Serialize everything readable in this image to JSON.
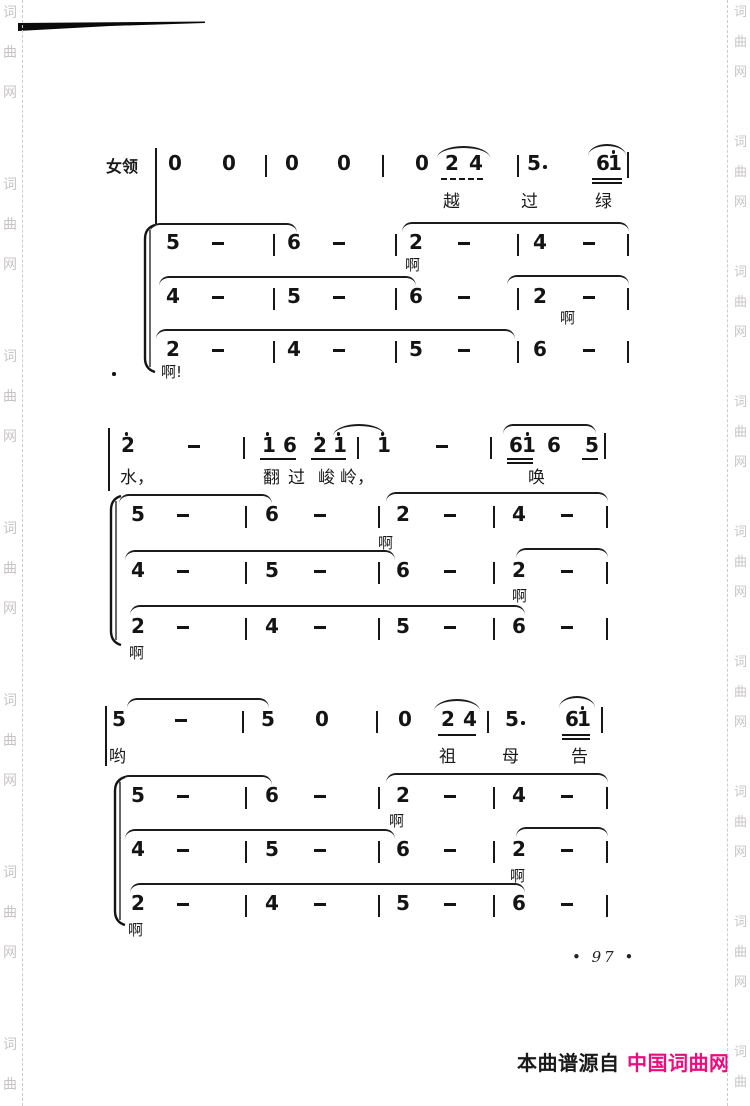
{
  "page": {
    "width": 750,
    "height": 1106,
    "background": "#ffffff"
  },
  "watermark": {
    "text": "词曲网",
    "chars": [
      "词",
      "曲",
      "网"
    ],
    "color": "#c8c4c6",
    "left": {
      "x": 3,
      "line_x": 22,
      "start": 6,
      "char_gap": 40,
      "group_period": 172,
      "font_size": 14
    },
    "right": {
      "x": 734,
      "line_x": 727,
      "start": 6,
      "char_gap": 30,
      "group_period": 130,
      "font_size": 13
    }
  },
  "artifact": {
    "points": "18,3 205,1.5 205,3 110,6 18,11",
    "color": "#0a0a0a"
  },
  "page_number": {
    "text": "• 97 •",
    "x": 572,
    "y": 948
  },
  "footer": {
    "left": {
      "text": "本曲谱源自",
      "x": 517,
      "y": 1053,
      "color": "#1a1a1a"
    },
    "right": {
      "text": "中国词曲网",
      "x": 627,
      "y": 1053,
      "color": "#ef0b7e"
    }
  },
  "score": {
    "ink": "#141414",
    "label": {
      "text": "女领",
      "x": 106,
      "y": 159,
      "fs": 16
    },
    "stray_dot": {
      "x": 112,
      "y": 372
    },
    "braces": [
      {
        "x": 142,
        "y1": 224,
        "y2": 373
      },
      {
        "x": 108,
        "y1": 495,
        "y2": 646
      },
      {
        "x": 112,
        "y1": 776,
        "y2": 926
      }
    ],
    "rows": [
      {
        "name": "system1-lead",
        "y": 157,
        "tokens": [
          {
            "x": 155,
            "c": "|",
            "dy": -9,
            "h": 76
          },
          {
            "x": 168,
            "c": "0"
          },
          {
            "x": 222,
            "c": "0"
          },
          {
            "x": 265,
            "c": "|"
          },
          {
            "x": 285,
            "c": "0"
          },
          {
            "x": 337,
            "c": "0"
          },
          {
            "x": 382,
            "c": "|"
          },
          {
            "x": 415,
            "c": "0"
          },
          {
            "x": 445,
            "c": "2"
          },
          {
            "x": 469,
            "c": "4"
          },
          {
            "x": 517,
            "c": "|"
          },
          {
            "x": 527,
            "c": "5",
            "aug": true
          },
          {
            "x": 596,
            "c": "6"
          },
          {
            "x": 608,
            "c": "1",
            "dot": true
          },
          {
            "x": 627,
            "c": "|",
            "dy": -5,
            "h": 26
          }
        ],
        "unders": [
          {
            "x1": 441,
            "x2": 483,
            "y": 178,
            "dashed": true
          },
          {
            "x1": 592,
            "x2": 622,
            "y": 178,
            "double": true
          }
        ],
        "slurs": [
          {
            "x1": 437,
            "x2": 490,
            "y": 146,
            "arc": true
          },
          {
            "x1": 588,
            "x2": 626,
            "y": 144,
            "arc": true
          }
        ],
        "lyrics": [
          {
            "x": 443,
            "y": 194,
            "t": "越",
            "fs": 17
          },
          {
            "x": 521,
            "y": 194,
            "t": "过",
            "fs": 17
          },
          {
            "x": 595,
            "y": 194,
            "t": "绿",
            "fs": 17
          }
        ]
      },
      {
        "name": "system1-voice1",
        "y": 236,
        "tokens": [
          {
            "x": 166,
            "c": "5"
          },
          {
            "x": 212,
            "c": "-"
          },
          {
            "x": 273,
            "c": "|"
          },
          {
            "x": 287,
            "c": "6"
          },
          {
            "x": 333,
            "c": "-"
          },
          {
            "x": 395,
            "c": "|"
          },
          {
            "x": 409,
            "c": "2"
          },
          {
            "x": 458,
            "c": "-"
          },
          {
            "x": 517,
            "c": "|"
          },
          {
            "x": 533,
            "c": "4"
          },
          {
            "x": 583,
            "c": "-"
          },
          {
            "x": 627,
            "c": "|"
          }
        ],
        "slurs": [
          {
            "x1": 150,
            "x2": 297,
            "y": 223
          },
          {
            "x1": 402,
            "x2": 629,
            "y": 222
          }
        ],
        "lyrics": [
          {
            "x": 405,
            "y": 258,
            "t": "啊",
            "fs": 15
          }
        ]
      },
      {
        "name": "system1-voice2",
        "y": 290,
        "tokens": [
          {
            "x": 166,
            "c": "4"
          },
          {
            "x": 212,
            "c": "-"
          },
          {
            "x": 273,
            "c": "|"
          },
          {
            "x": 287,
            "c": "5"
          },
          {
            "x": 333,
            "c": "-"
          },
          {
            "x": 395,
            "c": "|"
          },
          {
            "x": 409,
            "c": "6"
          },
          {
            "x": 458,
            "c": "-"
          },
          {
            "x": 517,
            "c": "|"
          },
          {
            "x": 533,
            "c": "2"
          },
          {
            "x": 583,
            "c": "-"
          },
          {
            "x": 627,
            "c": "|"
          }
        ],
        "slurs": [
          {
            "x1": 159,
            "x2": 416,
            "y": 276
          },
          {
            "x1": 507,
            "x2": 629,
            "y": 275
          }
        ],
        "lyrics": [
          {
            "x": 560,
            "y": 311,
            "t": "啊",
            "fs": 15
          }
        ]
      },
      {
        "name": "system1-voice3",
        "y": 343,
        "tokens": [
          {
            "x": 166,
            "c": "2"
          },
          {
            "x": 212,
            "c": "-"
          },
          {
            "x": 273,
            "c": "|"
          },
          {
            "x": 287,
            "c": "4"
          },
          {
            "x": 333,
            "c": "-"
          },
          {
            "x": 395,
            "c": "|"
          },
          {
            "x": 409,
            "c": "5"
          },
          {
            "x": 458,
            "c": "-"
          },
          {
            "x": 517,
            "c": "|"
          },
          {
            "x": 533,
            "c": "6"
          },
          {
            "x": 583,
            "c": "-"
          },
          {
            "x": 627,
            "c": "|"
          }
        ],
        "slurs": [
          {
            "x1": 156,
            "x2": 515,
            "y": 329
          }
        ],
        "lyrics": [
          {
            "x": 161,
            "y": 365,
            "t": "啊!",
            "fs": 15
          }
        ]
      },
      {
        "name": "system2-lead",
        "y": 439,
        "tokens": [
          {
            "x": 108,
            "c": "|",
            "dy": -11,
            "h": 63
          },
          {
            "x": 121,
            "c": "2",
            "dot": true
          },
          {
            "x": 188,
            "c": "-"
          },
          {
            "x": 243,
            "c": "|"
          },
          {
            "x": 262,
            "c": "1",
            "dot": true
          },
          {
            "x": 283,
            "c": "6"
          },
          {
            "x": 313,
            "c": "2",
            "dot": true
          },
          {
            "x": 333,
            "c": "1",
            "dot": true
          },
          {
            "x": 357,
            "c": "|"
          },
          {
            "x": 377,
            "c": "1",
            "dot": true
          },
          {
            "x": 436,
            "c": "-"
          },
          {
            "x": 490,
            "c": "|"
          },
          {
            "x": 509,
            "c": "6"
          },
          {
            "x": 522,
            "c": "1",
            "dot": true
          },
          {
            "x": 547,
            "c": "6"
          },
          {
            "x": 585,
            "c": "5"
          },
          {
            "x": 604,
            "c": "|",
            "dy": -6,
            "h": 26
          }
        ],
        "unders": [
          {
            "x1": 260,
            "x2": 296,
            "y": 458
          },
          {
            "x1": 311,
            "x2": 346,
            "y": 458
          },
          {
            "x1": 507,
            "x2": 533,
            "y": 458,
            "double": true
          },
          {
            "x1": 582,
            "x2": 598,
            "y": 458
          }
        ],
        "slurs": [
          {
            "x1": 333,
            "x2": 385,
            "y": 424,
            "arc": true
          },
          {
            "x1": 503,
            "x2": 596,
            "y": 424
          }
        ],
        "lyrics": [
          {
            "x": 120,
            "y": 470,
            "t": "水，",
            "fs": 17
          },
          {
            "x": 263,
            "y": 470,
            "t": "翻",
            "fs": 17
          },
          {
            "x": 288,
            "y": 470,
            "t": "过",
            "fs": 17
          },
          {
            "x": 318,
            "y": 470,
            "t": "峻",
            "fs": 17
          },
          {
            "x": 340,
            "y": 470,
            "t": "岭，",
            "fs": 17
          },
          {
            "x": 528,
            "y": 470,
            "t": "唤",
            "fs": 17
          }
        ]
      },
      {
        "name": "system2-voice1",
        "y": 508,
        "tokens": [
          {
            "x": 131,
            "c": "5"
          },
          {
            "x": 177,
            "c": "-"
          },
          {
            "x": 245,
            "c": "|"
          },
          {
            "x": 265,
            "c": "6"
          },
          {
            "x": 314,
            "c": "-"
          },
          {
            "x": 378,
            "c": "|"
          },
          {
            "x": 396,
            "c": "2"
          },
          {
            "x": 444,
            "c": "-"
          },
          {
            "x": 493,
            "c": "|"
          },
          {
            "x": 512,
            "c": "4"
          },
          {
            "x": 561,
            "c": "-"
          },
          {
            "x": 606,
            "c": "|"
          }
        ],
        "slurs": [
          {
            "x1": 119,
            "x2": 272,
            "y": 494
          },
          {
            "x1": 386,
            "x2": 608,
            "y": 492
          }
        ],
        "lyrics": [
          {
            "x": 378,
            "y": 536,
            "t": "啊",
            "fs": 15
          }
        ]
      },
      {
        "name": "system2-voice2",
        "y": 564,
        "tokens": [
          {
            "x": 131,
            "c": "4"
          },
          {
            "x": 177,
            "c": "-"
          },
          {
            "x": 245,
            "c": "|"
          },
          {
            "x": 265,
            "c": "5"
          },
          {
            "x": 314,
            "c": "-"
          },
          {
            "x": 378,
            "c": "|"
          },
          {
            "x": 396,
            "c": "6"
          },
          {
            "x": 444,
            "c": "-"
          },
          {
            "x": 493,
            "c": "|"
          },
          {
            "x": 512,
            "c": "2"
          },
          {
            "x": 561,
            "c": "-"
          },
          {
            "x": 606,
            "c": "|"
          }
        ],
        "slurs": [
          {
            "x1": 125,
            "x2": 395,
            "y": 550
          },
          {
            "x1": 516,
            "x2": 608,
            "y": 548
          }
        ],
        "lyrics": [
          {
            "x": 512,
            "y": 589,
            "t": "啊",
            "fs": 15
          }
        ]
      },
      {
        "name": "system2-voice3",
        "y": 620,
        "tokens": [
          {
            "x": 131,
            "c": "2"
          },
          {
            "x": 177,
            "c": "-"
          },
          {
            "x": 245,
            "c": "|"
          },
          {
            "x": 265,
            "c": "4"
          },
          {
            "x": 314,
            "c": "-"
          },
          {
            "x": 378,
            "c": "|"
          },
          {
            "x": 396,
            "c": "5"
          },
          {
            "x": 444,
            "c": "-"
          },
          {
            "x": 493,
            "c": "|"
          },
          {
            "x": 512,
            "c": "6"
          },
          {
            "x": 561,
            "c": "-"
          },
          {
            "x": 606,
            "c": "|"
          }
        ],
        "slurs": [
          {
            "x1": 130,
            "x2": 525,
            "y": 605
          }
        ],
        "lyrics": [
          {
            "x": 129,
            "y": 646,
            "t": "啊",
            "fs": 15
          }
        ]
      },
      {
        "name": "system3-lead",
        "y": 713,
        "tokens": [
          {
            "x": 105,
            "c": "|",
            "dy": -7,
            "h": 60
          },
          {
            "x": 112,
            "c": "5"
          },
          {
            "x": 175,
            "c": "-"
          },
          {
            "x": 242,
            "c": "|"
          },
          {
            "x": 261,
            "c": "5"
          },
          {
            "x": 315,
            "c": "0"
          },
          {
            "x": 376,
            "c": "|"
          },
          {
            "x": 398,
            "c": "0"
          },
          {
            "x": 441,
            "c": "2"
          },
          {
            "x": 463,
            "c": "4"
          },
          {
            "x": 487,
            "c": "|"
          },
          {
            "x": 505,
            "c": "5",
            "aug": true
          },
          {
            "x": 565,
            "c": "6"
          },
          {
            "x": 577,
            "c": "1",
            "dot": true
          },
          {
            "x": 601,
            "c": "|",
            "dy": -6,
            "h": 26
          }
        ],
        "unders": [
          {
            "x1": 438,
            "x2": 476,
            "y": 734
          },
          {
            "x1": 562,
            "x2": 590,
            "y": 734,
            "double": true
          }
        ],
        "slurs": [
          {
            "x1": 127,
            "x2": 269,
            "y": 698
          },
          {
            "x1": 434,
            "x2": 480,
            "y": 699,
            "arc": true
          },
          {
            "x1": 559,
            "x2": 595,
            "y": 696,
            "arc": true
          }
        ],
        "lyrics": [
          {
            "x": 109,
            "y": 749,
            "t": "哟",
            "fs": 17
          },
          {
            "x": 439,
            "y": 749,
            "t": "祖",
            "fs": 17
          },
          {
            "x": 502,
            "y": 749,
            "t": "母",
            "fs": 17
          },
          {
            "x": 571,
            "y": 749,
            "t": "告",
            "fs": 17
          }
        ]
      },
      {
        "name": "system3-voice1",
        "y": 789,
        "tokens": [
          {
            "x": 131,
            "c": "5"
          },
          {
            "x": 177,
            "c": "-"
          },
          {
            "x": 245,
            "c": "|"
          },
          {
            "x": 265,
            "c": "6"
          },
          {
            "x": 314,
            "c": "-"
          },
          {
            "x": 378,
            "c": "|"
          },
          {
            "x": 396,
            "c": "2"
          },
          {
            "x": 444,
            "c": "-"
          },
          {
            "x": 493,
            "c": "|"
          },
          {
            "x": 512,
            "c": "4"
          },
          {
            "x": 561,
            "c": "-"
          },
          {
            "x": 606,
            "c": "|"
          }
        ],
        "slurs": [
          {
            "x1": 119,
            "x2": 272,
            "y": 775
          },
          {
            "x1": 386,
            "x2": 608,
            "y": 773
          }
        ],
        "lyrics": [
          {
            "x": 389,
            "y": 814,
            "t": "啊",
            "fs": 15
          }
        ]
      },
      {
        "name": "system3-voice2",
        "y": 843,
        "tokens": [
          {
            "x": 131,
            "c": "4"
          },
          {
            "x": 177,
            "c": "-"
          },
          {
            "x": 245,
            "c": "|"
          },
          {
            "x": 265,
            "c": "5"
          },
          {
            "x": 314,
            "c": "-"
          },
          {
            "x": 378,
            "c": "|"
          },
          {
            "x": 396,
            "c": "6"
          },
          {
            "x": 444,
            "c": "-"
          },
          {
            "x": 378,
            "c": ""
          },
          {
            "x": 493,
            "c": "|"
          },
          {
            "x": 512,
            "c": "2"
          },
          {
            "x": 561,
            "c": "-"
          },
          {
            "x": 606,
            "c": "|"
          }
        ],
        "slurs": [
          {
            "x1": 125,
            "x2": 395,
            "y": 829
          },
          {
            "x1": 516,
            "x2": 608,
            "y": 827
          }
        ],
        "lyrics": [
          {
            "x": 510,
            "y": 869,
            "t": "啊",
            "fs": 15
          }
        ]
      },
      {
        "name": "system3-voice3",
        "y": 897,
        "tokens": [
          {
            "x": 131,
            "c": "2"
          },
          {
            "x": 177,
            "c": "-"
          },
          {
            "x": 245,
            "c": "|"
          },
          {
            "x": 265,
            "c": "4"
          },
          {
            "x": 314,
            "c": "-"
          },
          {
            "x": 378,
            "c": "|"
          },
          {
            "x": 396,
            "c": "5"
          },
          {
            "x": 444,
            "c": "-"
          },
          {
            "x": 493,
            "c": "|"
          },
          {
            "x": 512,
            "c": "6"
          },
          {
            "x": 561,
            "c": "-"
          },
          {
            "x": 606,
            "c": "|"
          }
        ],
        "slurs": [
          {
            "x1": 130,
            "x2": 525,
            "y": 883
          }
        ],
        "lyrics": [
          {
            "x": 128,
            "y": 923,
            "t": "啊",
            "fs": 15
          }
        ]
      }
    ]
  }
}
